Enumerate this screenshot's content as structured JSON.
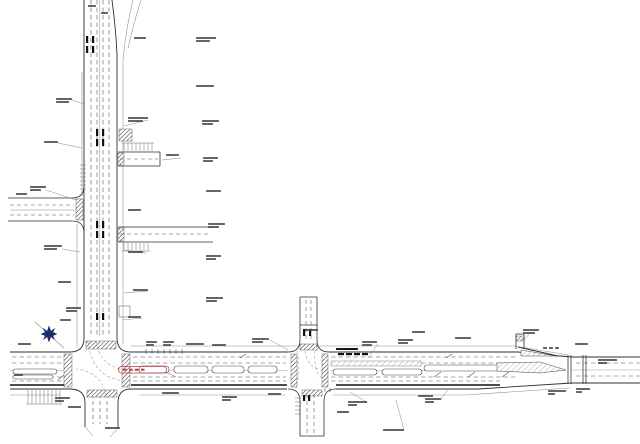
{
  "document": {
    "type": "road-improvement-plan-drawing",
    "description": "CAD plan of a north-south arterial meeting an east-west arterial; crosswalk hatching, median islands, side streets, north arrow, one red highlighted callout",
    "background": "#ffffff"
  },
  "colors": {
    "ink": "#2f2f2f",
    "light": "#8f8f8f",
    "dash": "#565656",
    "bold": "#101010",
    "north_arrow": "#1b2c6b",
    "highlight_red": "#c43b3b"
  },
  "annotations": [
    {
      "x": 88,
      "y": 5,
      "w": 8,
      "w2": 0
    },
    {
      "x": 101,
      "y": 12,
      "w": 7,
      "w2": 0
    },
    {
      "x": 134,
      "y": 37,
      "w": 12,
      "w2": 0
    },
    {
      "x": 196,
      "y": 37,
      "w": 20,
      "w2": 14
    },
    {
      "x": 196,
      "y": 85,
      "w": 18,
      "w2": 0
    },
    {
      "x": 56,
      "y": 98,
      "w": 16,
      "w2": 13
    },
    {
      "x": 128,
      "y": 117,
      "w": 20,
      "w2": 15
    },
    {
      "x": 202,
      "y": 120,
      "w": 17,
      "w2": 11
    },
    {
      "x": 44,
      "y": 141,
      "w": 14,
      "w2": 0
    },
    {
      "x": 166,
      "y": 154,
      "w": 13,
      "w2": 0
    },
    {
      "x": 203,
      "y": 157,
      "w": 15,
      "w2": 10
    },
    {
      "x": 30,
      "y": 186,
      "w": 16,
      "w2": 11
    },
    {
      "x": 206,
      "y": 190,
      "w": 15,
      "w2": 0
    },
    {
      "x": 16,
      "y": 193,
      "w": 11,
      "w2": 0
    },
    {
      "x": 128,
      "y": 209,
      "w": 13,
      "w2": 0
    },
    {
      "x": 208,
      "y": 223,
      "w": 17,
      "w2": 11
    },
    {
      "x": 44,
      "y": 245,
      "w": 18,
      "w2": 13
    },
    {
      "x": 128,
      "y": 251,
      "w": 15,
      "w2": 0
    },
    {
      "x": 206,
      "y": 255,
      "w": 15,
      "w2": 10
    },
    {
      "x": 58,
      "y": 281,
      "w": 13,
      "w2": 0
    },
    {
      "x": 133,
      "y": 289,
      "w": 15,
      "w2": 0
    },
    {
      "x": 206,
      "y": 297,
      "w": 17,
      "w2": 11
    },
    {
      "x": 66,
      "y": 307,
      "w": 15,
      "w2": 11
    },
    {
      "x": 60,
      "y": 319,
      "w": 11,
      "w2": 0
    },
    {
      "x": 128,
      "y": 316,
      "w": 13,
      "w2": 0
    },
    {
      "x": 18,
      "y": 343,
      "w": 13,
      "w2": 0
    },
    {
      "x": 146,
      "y": 341,
      "w": 11,
      "w2": 8
    },
    {
      "x": 163,
      "y": 341,
      "w": 11,
      "w2": 8
    },
    {
      "x": 186,
      "y": 343,
      "w": 18,
      "w2": 0
    },
    {
      "x": 212,
      "y": 344,
      "w": 14,
      "w2": 0
    },
    {
      "x": 252,
      "y": 338,
      "w": 17,
      "w2": 11
    },
    {
      "x": 305,
      "y": 329,
      "w": 13,
      "w2": 0
    },
    {
      "x": 336,
      "y": 348,
      "w": 22,
      "w2": 0,
      "dark": true
    },
    {
      "x": 362,
      "y": 341,
      "w": 15,
      "w2": 10
    },
    {
      "x": 398,
      "y": 339,
      "w": 15,
      "w2": 10
    },
    {
      "x": 412,
      "y": 331,
      "w": 13,
      "w2": 0
    },
    {
      "x": 455,
      "y": 337,
      "w": 16,
      "w2": 0
    },
    {
      "x": 523,
      "y": 329,
      "w": 16,
      "w2": 12
    },
    {
      "x": 543,
      "y": 347,
      "w": 4,
      "w2": 0
    },
    {
      "x": 549,
      "y": 347,
      "w": 4,
      "w2": 0
    },
    {
      "x": 555,
      "y": 347,
      "w": 4,
      "w2": 0
    },
    {
      "x": 575,
      "y": 343,
      "w": 13,
      "w2": 0
    },
    {
      "x": 598,
      "y": 359,
      "w": 19,
      "w2": 9
    },
    {
      "x": 14,
      "y": 374,
      "w": 9,
      "w2": 0
    },
    {
      "x": 55,
      "y": 397,
      "w": 15,
      "w2": 9
    },
    {
      "x": 68,
      "y": 406,
      "w": 13,
      "w2": 0
    },
    {
      "x": 105,
      "y": 427,
      "w": 15,
      "w2": 0
    },
    {
      "x": 162,
      "y": 392,
      "w": 17,
      "w2": 0
    },
    {
      "x": 222,
      "y": 396,
      "w": 15,
      "w2": 9
    },
    {
      "x": 268,
      "y": 393,
      "w": 13,
      "w2": 0
    },
    {
      "x": 337,
      "y": 411,
      "w": 12,
      "w2": 0
    },
    {
      "x": 348,
      "y": 401,
      "w": 19,
      "w2": 9
    },
    {
      "x": 383,
      "y": 429,
      "w": 21,
      "w2": 0
    },
    {
      "x": 418,
      "y": 395,
      "w": 15,
      "w2": 0
    },
    {
      "x": 425,
      "y": 398,
      "w": 16,
      "w2": 9
    },
    {
      "x": 548,
      "y": 390,
      "w": 18,
      "w2": 7
    },
    {
      "x": 576,
      "y": 388,
      "w": 14,
      "w2": 6
    }
  ]
}
